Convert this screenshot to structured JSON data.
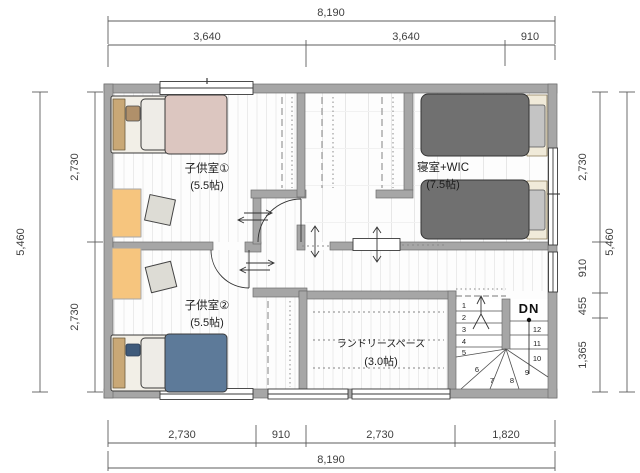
{
  "plan_title": "2F floor plan",
  "rooms": {
    "kids1": {
      "name": "子供室①",
      "size": "(5.5帖)"
    },
    "kids2": {
      "name": "子供室②",
      "size": "(5.5帖)"
    },
    "master": {
      "name": "寝室+WIC",
      "size": "(7.5帖)"
    },
    "laundry": {
      "name": "ランドリースペース",
      "size": "(3.0帖)"
    }
  },
  "stairs": {
    "label": "DN",
    "steps": [
      "1",
      "2",
      "3",
      "4",
      "5",
      "6",
      "7",
      "8",
      "9",
      "10",
      "11",
      "12"
    ]
  },
  "dims": {
    "top_total": "8,190",
    "top": [
      "3,640",
      "3,640",
      "910"
    ],
    "bottom": [
      "2,730",
      "910",
      "2,730",
      "1,820"
    ],
    "bottom_total": "8,190",
    "left": [
      "2,730",
      "2,730"
    ],
    "left_total": "5,460",
    "right": [
      "2,730",
      "910",
      "455",
      "1,365"
    ],
    "right_total": "5,460"
  },
  "colors": {
    "wall": "#a6a6a6",
    "desk": "#f6c57e",
    "kids1_blanket": "#dcc6c0",
    "kids2_blanket": "#5d7a99",
    "master_blanket": "#707070",
    "headboard": "#c9a876",
    "floor_stripe": "#e9e9e9"
  }
}
